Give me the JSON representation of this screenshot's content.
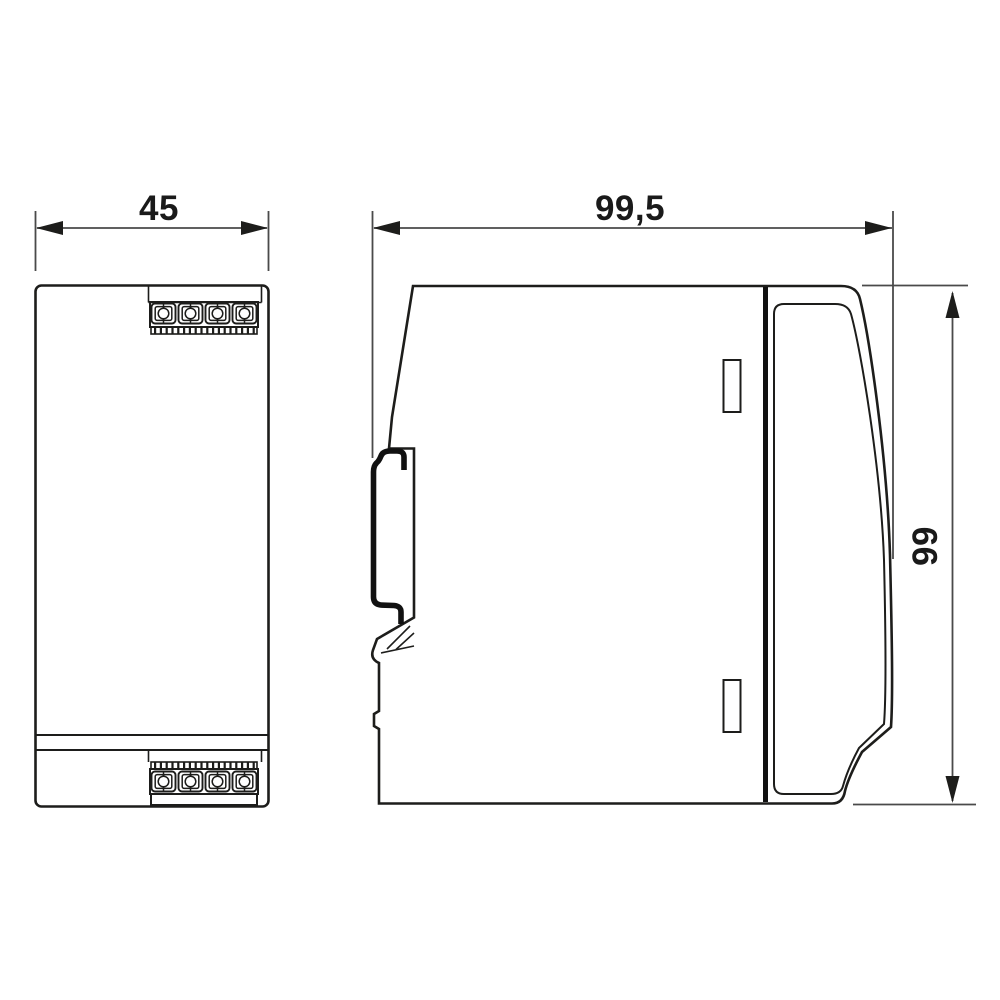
{
  "drawing": {
    "kind": "technical-dimension-drawing",
    "views": [
      {
        "id": "front-view",
        "description": "front elevation with plug-in screw terminal blocks top and bottom"
      },
      {
        "id": "side-view",
        "description": "side elevation with DIN rail mounting foot and curved front cover"
      }
    ]
  },
  "dimensions": {
    "front_width": {
      "label": "45"
    },
    "side_depth": {
      "label": "99,5"
    },
    "side_height": {
      "label": "99"
    }
  },
  "colors": {
    "line": "#1d1d1b",
    "dimension_line": "#4a4a4a",
    "background": "#ffffff"
  }
}
